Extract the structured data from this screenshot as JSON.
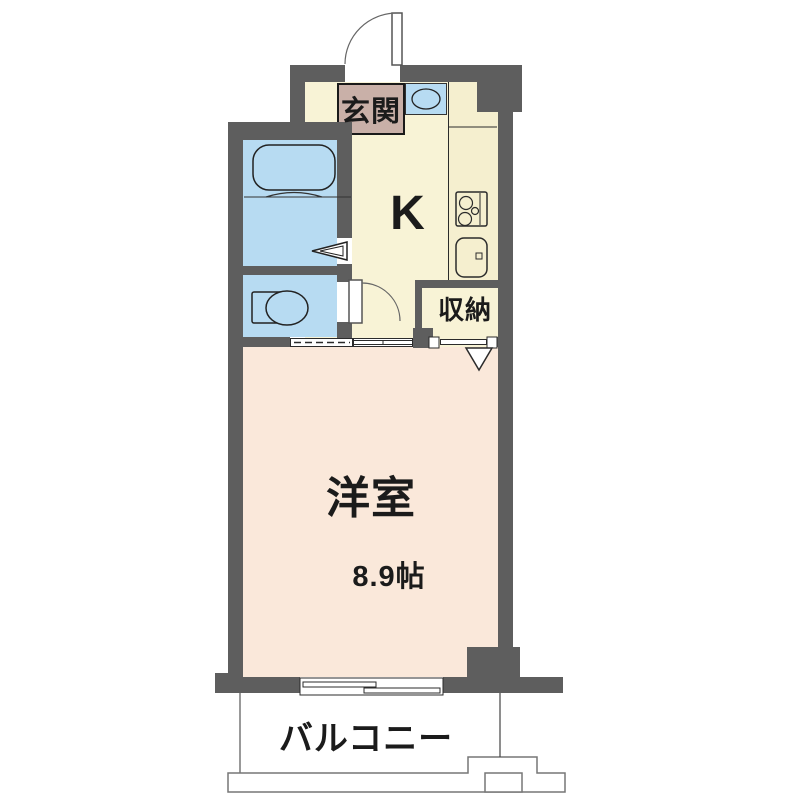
{
  "plan": {
    "rooms": {
      "genkan": "玄関",
      "kitchen": "K",
      "storage": "収納",
      "western_room": "洋室",
      "western_room_size": "8.9帖",
      "balcony": "バルコニー"
    },
    "fixtures": [
      "bathtub",
      "toilet",
      "washbasin",
      "gas-stove",
      "kitchen-sink",
      "entrance-door",
      "folding-door",
      "hinged-door",
      "sliding-door",
      "closet-folding-door",
      "sliding-window",
      "balcony-partition"
    ],
    "colors": {
      "wall": "#5e5e5e",
      "kitchen_floor": "#f8f3d6",
      "counter": "#f5efcf",
      "genkan_floor": "#c9b0a8",
      "water_area": "#b7dbf2",
      "room_floor": "#fae8da",
      "line": "#2b2b2b",
      "balcony_line": "#777777"
    }
  }
}
